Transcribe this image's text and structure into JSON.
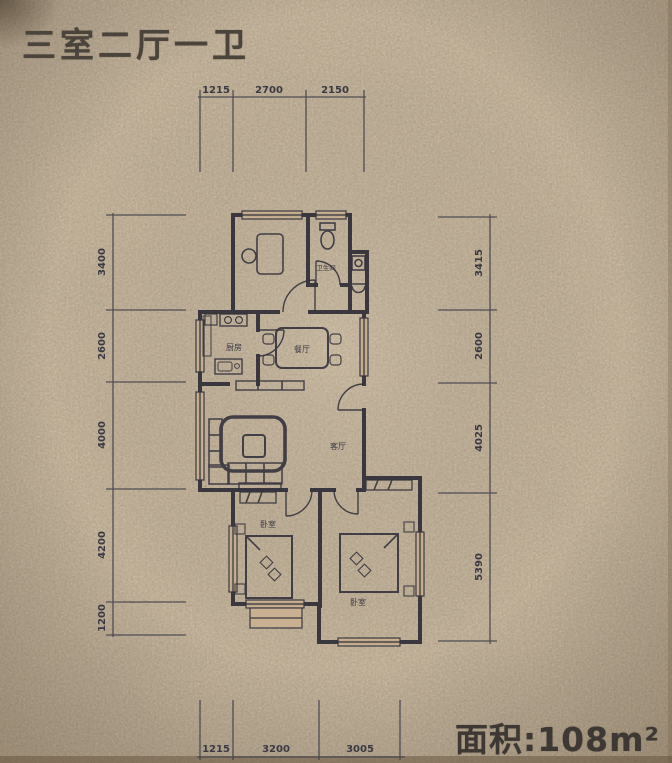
{
  "header": {
    "title": "三室二厅一卫"
  },
  "footer": {
    "area": "面积:108m²"
  },
  "dimensions": {
    "top": [
      "1215",
      "2700",
      "2150"
    ],
    "bottom": [
      "1215",
      "3200",
      "3005"
    ],
    "left": [
      "3400",
      "2600",
      "4000",
      "4200",
      "1200"
    ],
    "right": [
      "3415",
      "2600",
      "4025",
      "5390"
    ]
  },
  "rooms": {
    "bathroom": "卫生间",
    "kitchen": "厨房",
    "dining": "餐厅",
    "living": "客厅",
    "bedroom_left": "卧室",
    "bedroom_right": "卧室"
  },
  "colors": {
    "background": "#c6ae8d",
    "wall_line": "#2f2e37",
    "dim_text": "#413f49",
    "title_text": "#4a443c"
  }
}
